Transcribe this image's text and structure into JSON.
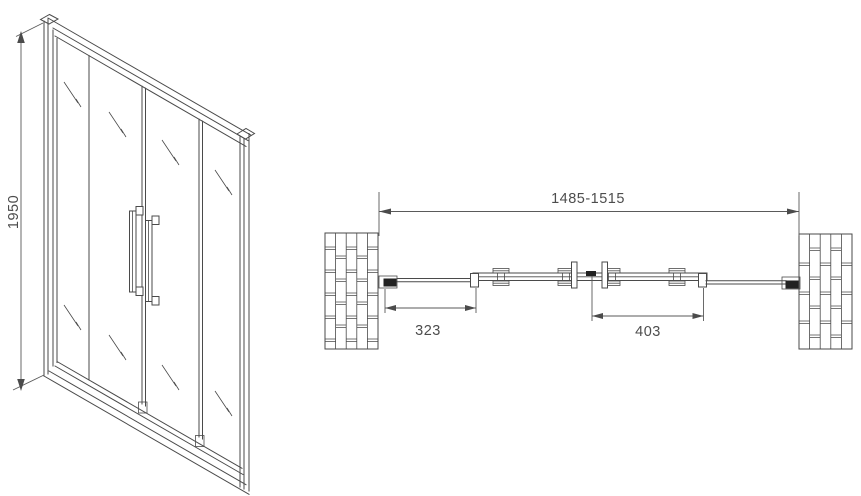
{
  "title": "Sliding shower door technical drawing",
  "front_view": {
    "height_label": "1950"
  },
  "plan_view": {
    "overall_width_label": "1485-1515",
    "left_door_label": "323",
    "right_door_label": "403"
  },
  "colors": {
    "line": "#4a4a4a",
    "dimension_line": "#5a5a5a",
    "text": "#4d4d4d",
    "bracket_fill": "#222222",
    "background": "#ffffff"
  }
}
